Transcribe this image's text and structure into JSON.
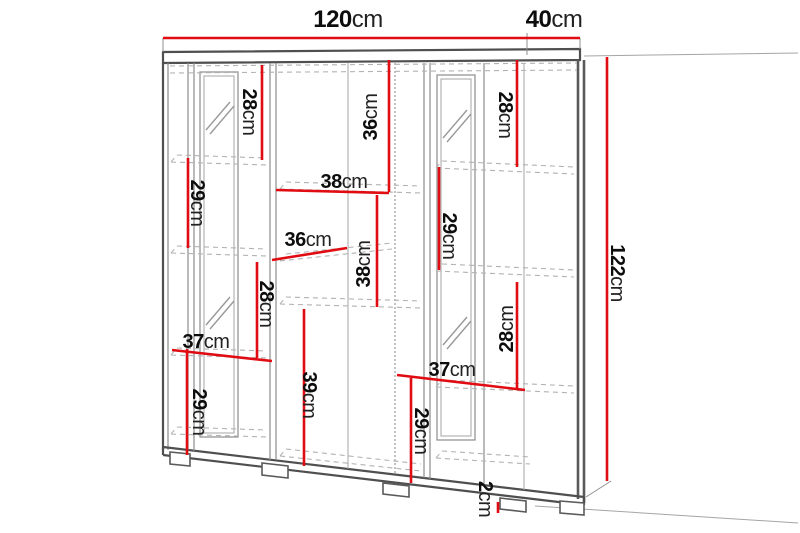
{
  "figure": {
    "kind": "furniture-dimension-diagram",
    "subject": "display cabinet with two glass doors, open center shelves and feet",
    "background": "#ffffff",
    "accent_red": "#e10b12",
    "line_gray": "#5a5a5a",
    "canvas": {
      "width": 800,
      "height": 533
    }
  },
  "dimensions": [
    {
      "id": "total-width",
      "num": "120",
      "unit": "cm",
      "orientation": "horizontal",
      "size": "lg",
      "label": {
        "x": 348,
        "y": 20
      },
      "line": {
        "x1": 163,
        "y1": 38,
        "x2": 527,
        "y2": 38
      }
    },
    {
      "id": "total-depth",
      "num": "40",
      "unit": "cm",
      "orientation": "horizontal",
      "size": "lg",
      "label": {
        "x": 554,
        "y": 20
      },
      "line": {
        "x1": 527,
        "y1": 38,
        "x2": 580,
        "y2": 38
      }
    },
    {
      "id": "total-height",
      "num": "122",
      "unit": "cm",
      "orientation": "vertical-down",
      "size": "md",
      "label": {
        "x": 617,
        "y": 273
      },
      "line": {
        "x1": 607,
        "y1": 57,
        "x2": 607,
        "y2": 481
      }
    },
    {
      "id": "left-top-gap",
      "num": "28",
      "unit": "cm",
      "orientation": "vertical-down",
      "size": "md",
      "label": {
        "x": 249,
        "y": 112
      },
      "line": {
        "x1": 262,
        "y1": 65,
        "x2": 262,
        "y2": 160
      }
    },
    {
      "id": "left-upper-gap",
      "num": "29",
      "unit": "cm",
      "orientation": "vertical-down",
      "size": "md",
      "label": {
        "x": 197,
        "y": 203
      },
      "line": {
        "x1": 188,
        "y1": 158,
        "x2": 188,
        "y2": 248
      }
    },
    {
      "id": "left-mid-gap",
      "num": "28",
      "unit": "cm",
      "orientation": "vertical-down",
      "size": "md",
      "label": {
        "x": 266,
        "y": 304
      },
      "line": {
        "x1": 257,
        "y1": 262,
        "x2": 257,
        "y2": 358
      }
    },
    {
      "id": "left-bottom-gap",
      "num": "29",
      "unit": "cm",
      "orientation": "vertical-down",
      "size": "md",
      "label": {
        "x": 199,
        "y": 412
      },
      "line": {
        "x1": 187,
        "y1": 349,
        "x2": 187,
        "y2": 455
      }
    },
    {
      "id": "left-shelf-width",
      "num": "37",
      "unit": "cm",
      "orientation": "horizontal",
      "size": "md",
      "label": {
        "x": 206,
        "y": 342
      },
      "line": {
        "x1": 172,
        "y1": 350,
        "x2": 272,
        "y2": 361
      }
    },
    {
      "id": "center-bottom-gap",
      "num": "39",
      "unit": "cm",
      "orientation": "vertical-down",
      "size": "md",
      "label": {
        "x": 309,
        "y": 395
      },
      "line": {
        "x1": 304,
        "y1": 309,
        "x2": 304,
        "y2": 466
      }
    },
    {
      "id": "center-top-gap",
      "num": "36",
      "unit": "cm",
      "orientation": "vertical-up",
      "size": "md",
      "label": {
        "x": 371,
        "y": 117
      },
      "line": {
        "x1": 389,
        "y1": 60,
        "x2": 389,
        "y2": 192
      }
    },
    {
      "id": "center-shelf-width",
      "num": "38",
      "unit": "cm",
      "orientation": "horizontal",
      "size": "md",
      "label": {
        "x": 344,
        "y": 182
      },
      "line": {
        "x1": 276,
        "y1": 190,
        "x2": 389,
        "y2": 193
      }
    },
    {
      "id": "center-mid-width",
      "num": "36",
      "unit": "cm",
      "orientation": "horizontal",
      "size": "md",
      "label": {
        "x": 308,
        "y": 240
      },
      "line": {
        "x1": 272,
        "y1": 260,
        "x2": 347,
        "y2": 248
      }
    },
    {
      "id": "center-mid-gap",
      "num": "38",
      "unit": "cm",
      "orientation": "vertical-up",
      "size": "md",
      "label": {
        "x": 364,
        "y": 264
      },
      "line": {
        "x1": 377,
        "y1": 195,
        "x2": 377,
        "y2": 307
      }
    },
    {
      "id": "right-upper-gap",
      "num": "29",
      "unit": "cm",
      "orientation": "vertical-down",
      "size": "md",
      "label": {
        "x": 449,
        "y": 236
      },
      "line": {
        "x1": 439,
        "y1": 167,
        "x2": 439,
        "y2": 270
      }
    },
    {
      "id": "right-top-gap",
      "num": "28",
      "unit": "cm",
      "orientation": "vertical-down",
      "size": "md",
      "label": {
        "x": 505,
        "y": 115
      },
      "line": {
        "x1": 517,
        "y1": 60,
        "x2": 517,
        "y2": 167
      }
    },
    {
      "id": "right-lower-gap",
      "num": "28",
      "unit": "cm",
      "orientation": "vertical-up",
      "size": "md",
      "label": {
        "x": 507,
        "y": 329
      },
      "line": {
        "x1": 517,
        "y1": 282,
        "x2": 517,
        "y2": 388
      }
    },
    {
      "id": "right-shelf-width",
      "num": "37",
      "unit": "cm",
      "orientation": "horizontal",
      "size": "md",
      "label": {
        "x": 452,
        "y": 370
      },
      "line": {
        "x1": 397,
        "y1": 375,
        "x2": 525,
        "y2": 390
      }
    },
    {
      "id": "right-bottom-gap",
      "num": "29",
      "unit": "cm",
      "orientation": "vertical-down",
      "size": "md",
      "label": {
        "x": 421,
        "y": 431
      },
      "line": {
        "x1": 411,
        "y1": 378,
        "x2": 411,
        "y2": 483
      }
    },
    {
      "id": "foot-height",
      "num": "2",
      "unit": "cm",
      "orientation": "vertical-down",
      "size": "md",
      "label": {
        "x": 485,
        "y": 499
      },
      "line": {
        "x1": 498,
        "y1": 502,
        "x2": 498,
        "y2": 513
      }
    }
  ]
}
